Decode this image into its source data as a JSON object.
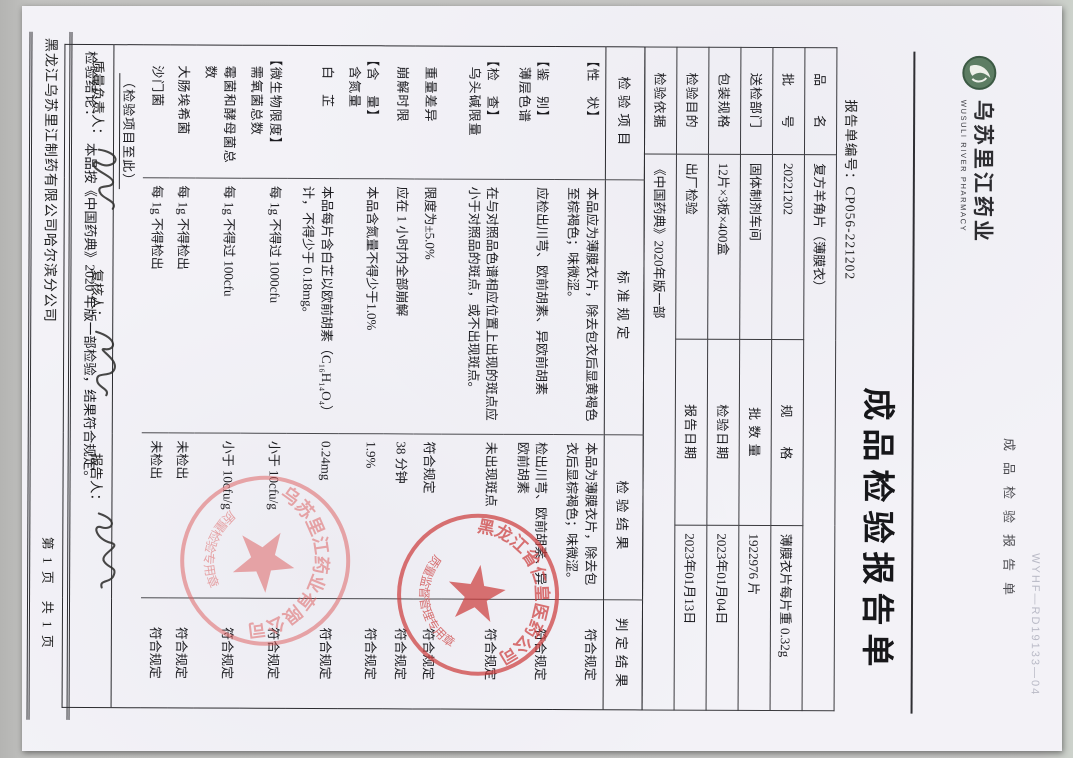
{
  "page": {
    "top_code": {
      "code": "WYHF—RD19133—04",
      "doc_type_side": "成品检验报告单"
    },
    "logo": {
      "name_cn": "乌苏里江药业",
      "name_en": "WUSULI RIVER PHARMACY"
    },
    "title": "成品检验报告单",
    "report_no_label": "报告单编号：",
    "report_no": "CP056-221202",
    "header_fields": {
      "name_label": "品　　名",
      "name_value": "复方羊角片（薄膜衣）",
      "batch_label": "批　　号",
      "batch_value": "20221202",
      "spec_label": "规　　格",
      "spec_value": "薄膜衣片每片重 0.32g",
      "dept_label": "送检部门",
      "dept_value": "固体制剂车间",
      "qty_label": "批 数 量",
      "qty_value": "1922976 片",
      "pack_label": "包装规格",
      "pack_value": "12片×3板×400盒",
      "test_date_label": "检验日期",
      "test_date_value": "2023年01月04日",
      "purpose_label": "检验目的",
      "purpose_value": "出厂检验",
      "report_date_label": "报告日期",
      "report_date_value": "2023年01月13日",
      "basis_label": "检验依据",
      "basis_value": "《中国药典》2020年版一部"
    },
    "table": {
      "headers": [
        "检验项目",
        "标准规定",
        "检验结果",
        "判定结果"
      ],
      "rows": [
        {
          "group": "【性　状】",
          "item": "",
          "standard": "本品应为薄膜衣片，除去包衣后显黄褐色至棕褐色；味微涩。",
          "result": "本品为薄膜衣片，除去包衣后显棕褐色；味微涩。",
          "judgment": "符合规定"
        },
        {
          "group": "【鉴　别】",
          "item": "薄层色谱",
          "standard": "应检出川芎、欧前胡素、异欧前胡素",
          "result": "检出川芎、欧前胡素、异欧前胡素",
          "judgment": "符合规定"
        },
        {
          "group": "【检　查】",
          "item": "乌头碱限量",
          "standard": "在与对照品色谱相应位置上出现的斑点应小于对照品的斑点，或不出现斑点。",
          "result": "未出现斑点",
          "judgment": "符合规定"
        },
        {
          "group": "",
          "item": "重量差异",
          "standard": "限度为±5.0%",
          "result": "符合规定",
          "judgment": "符合规定"
        },
        {
          "group": "",
          "item": "崩解时限",
          "standard": "应在 1 小时内全部崩解",
          "result": "38 分钟",
          "judgment": "符合规定"
        },
        {
          "group": "【含　量】",
          "item": "含氮量",
          "standard": "本品含氮量不得少于1.0%",
          "result": "1.9%",
          "judgment": "符合规定"
        },
        {
          "group": "",
          "item": "白　芷",
          "standard": "本品每片含白芷以欧前胡素（C₁₆H₁₄O₄）计，不得少于 0.18mg。",
          "result": "0.24mg",
          "judgment": "符合规定"
        },
        {
          "group": "【微生物限度】",
          "item": "需氧菌总数",
          "standard": "每 1g 不得过 1000cfu",
          "result": "小于 10cfu/g",
          "judgment": "符合规定"
        },
        {
          "group": "",
          "item": "霉菌和酵母菌总数",
          "standard": "每 1g 不得过 100cfu",
          "result": "小于 10cfu/g",
          "judgment": "符合规定"
        },
        {
          "group": "",
          "item": "大肠埃希菌",
          "standard": "每 1g 不得检出",
          "result": "未检出",
          "judgment": "符合规定"
        },
        {
          "group": "",
          "item": "沙门菌",
          "standard": "每 1g 不得检出",
          "result": "未检出",
          "judgment": "符合规定"
        }
      ],
      "end_note": "（检验项目至此）"
    },
    "conclusion_label": "检验结论：",
    "conclusion": "本品按《中国药典》2020 年版一部检验，结果符合规定。",
    "signers": {
      "quality_label": "质量负责人：",
      "review_label": "复核人：",
      "reporter_label": "报告人："
    },
    "stamps": [
      {
        "arc": "黑龙江省仁皇医药公司",
        "inner": "质量监督管理专用章"
      },
      {
        "arc": "乌苏里江药业有限公司",
        "inner": "质量检验专用章"
      }
    ],
    "footer": {
      "company": "黑龙江乌苏里江制药有限公司哈尔滨分公司",
      "page_info": "第 1 页　共 1 页"
    }
  }
}
